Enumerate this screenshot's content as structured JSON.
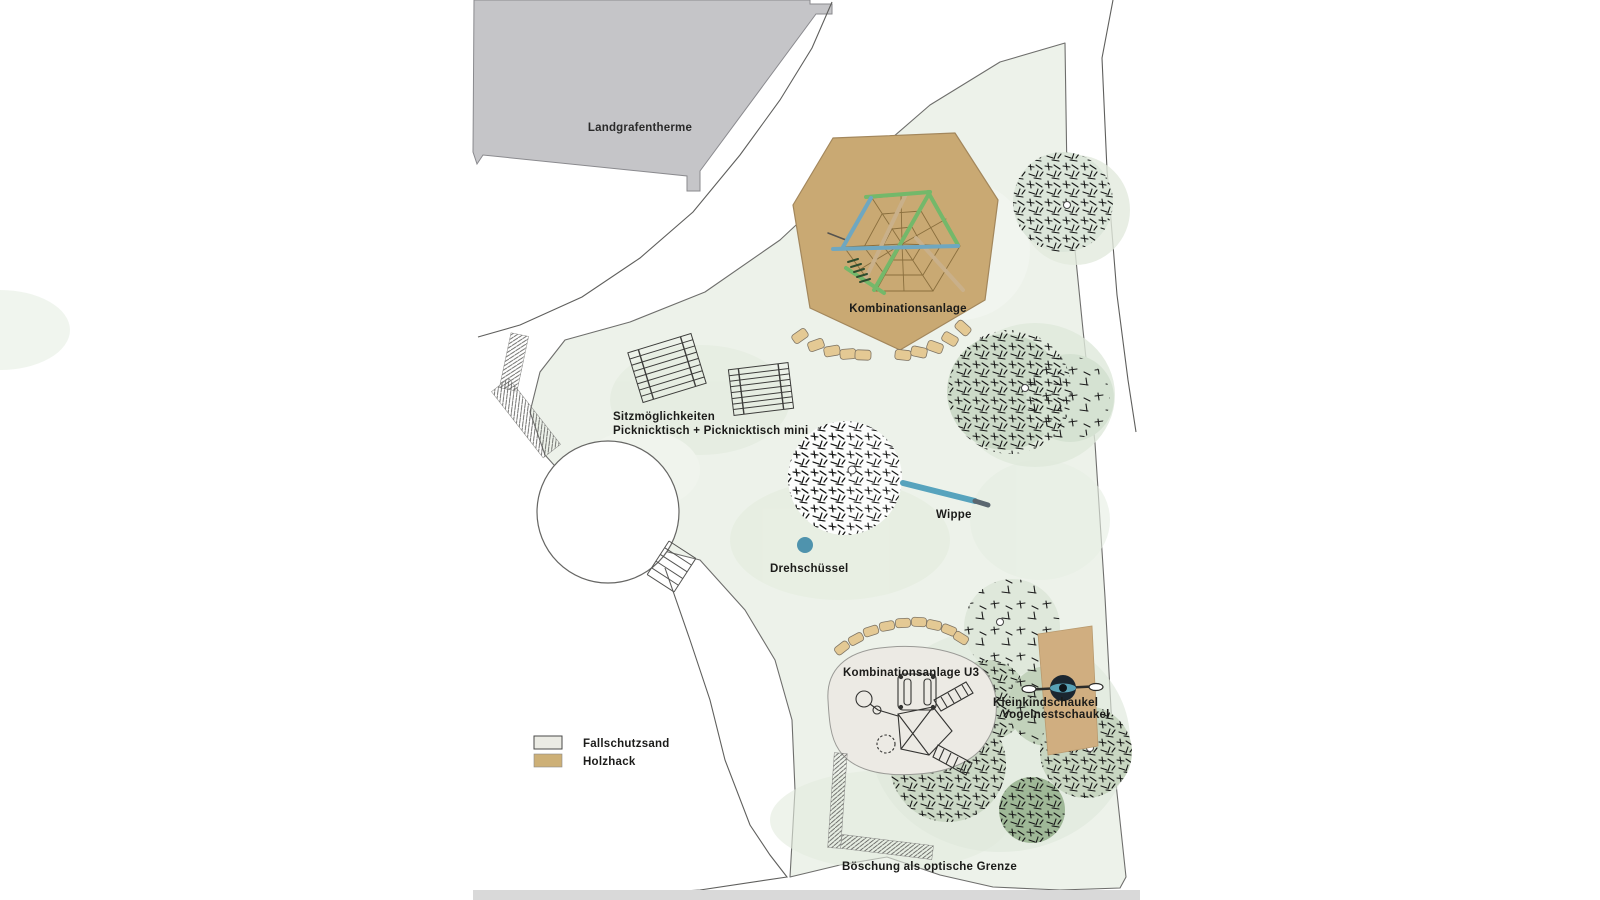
{
  "map": {
    "building_label": "Landgrafentherme",
    "labels": {
      "kombinationsanlage": "Kombinationsanlage",
      "seating_line1": "Sitzmöglichkeiten",
      "seating_line2": "Picknicktisch + Picknicktisch mini",
      "wippe": "Wippe",
      "drehschuessel": "Drehschüssel",
      "kombinationsanlage_u3": "Kombinationsanlage U3",
      "kleinkindschaukel": "Kleinkindschaukel",
      "vogelnestschaukel": "Vogelnestschaukel",
      "boeschung": "Böschung als optische Grenze"
    },
    "legend": {
      "items": [
        {
          "label": "Fallschutzsand",
          "color": "#ebebe4"
        },
        {
          "label": "Holzhack",
          "color": "#cdb077"
        }
      ]
    },
    "colors": {
      "lawn": "#edf2ea",
      "lawn_shade": "#dfe8db",
      "holzhack_surface": "#c9a973",
      "wood_block": "#e4c994",
      "sand_surface": "#eceae4",
      "building": "#c5c5c8",
      "tree_foliage": "#ccd9c6",
      "equipment_blue": "#4f93ad",
      "beam_green": "#74b86a",
      "beam_blue": "#6fa7c0",
      "bottom_strip": "#d9d9d9"
    }
  }
}
